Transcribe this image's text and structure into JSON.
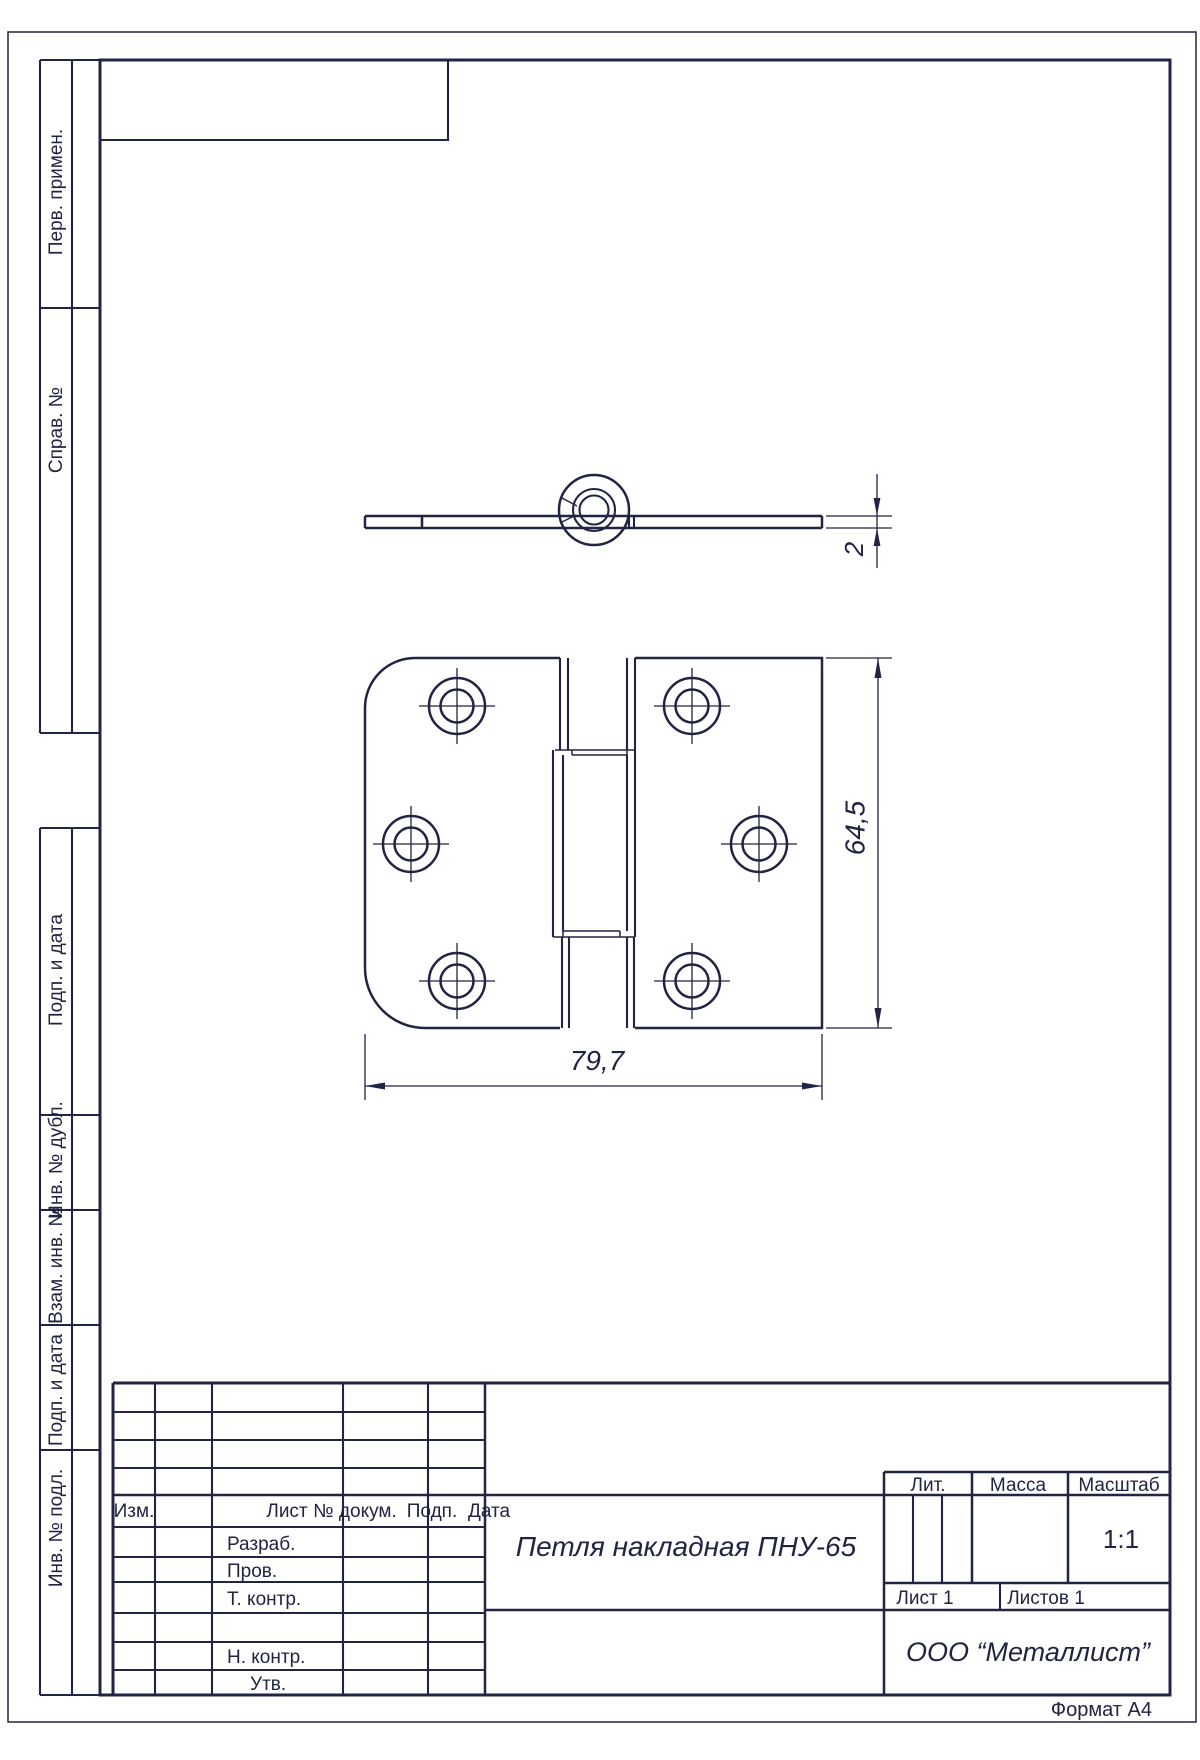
{
  "colors": {
    "ink": "#212442",
    "paper": "#ffffff"
  },
  "format_note": "Формат А4",
  "side_columns": {
    "perv": "Перв. примен.",
    "sprav": "Справ. №",
    "podp1": "Подп. и дата",
    "inv_dubl": "Инв. № дубл.",
    "vzam": "Взам. инв. №",
    "podp2": "Подп. и дата",
    "inv_podl": "Инв. № подл."
  },
  "title_block": {
    "izm": "Изм.",
    "list": "Лист",
    "dokum": "№ докум.",
    "podp": "Подп.",
    "data": "Дата",
    "razrab": "Разраб.",
    "prov": "Пров.",
    "t_kontr": "Т. контр.",
    "n_kontr": "Н. контр.",
    "utv": "Утв.",
    "doc_title": "Петля накладная ПНУ-65",
    "lit": "Лит.",
    "massa": "Масса",
    "masshtab": "Масштаб",
    "scale": "1:1",
    "sheet": "Лист 1",
    "sheets": "Листов 1",
    "company": "ООО “Металлист”"
  },
  "drawing": {
    "dim_width": "79,7",
    "dim_height": "64,5",
    "dim_thickness": "2"
  }
}
